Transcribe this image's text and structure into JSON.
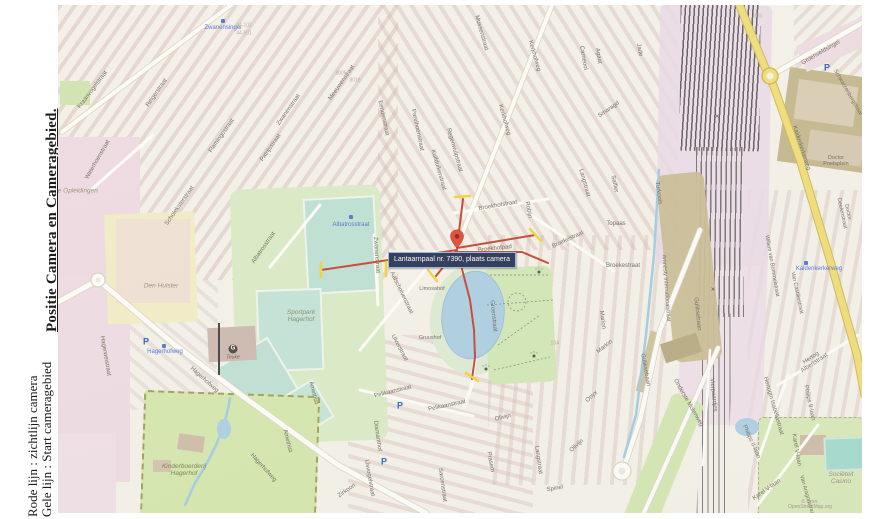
{
  "sidebar": {
    "title": "Positie Camera en Cameragebied.",
    "legend_red": "Rode lijn : zichtlijn camera",
    "legend_yellow": "Gele lijn : Start cameragebied"
  },
  "map": {
    "tooltip": "Lantaarnpaal nr. 7390, plaats camera",
    "attribution": "© Bron: OpenStreetMap.org",
    "colors": {
      "sightline_red": "#c23b28",
      "camera_area_yellow": "#f2d22e",
      "tooltip_bg": "#1f2c4e",
      "main_road_yellow": "#f0dc74",
      "water_blue": "#a9cee3",
      "park_green": "#cfe7b4",
      "sportfield_teal": "#badfd2",
      "railway_purple": "#e9d8e6",
      "transit_blue": "#4b6fd1"
    },
    "labels": [
      {
        "t": "Kraanvogelstraat",
        "x": 35,
        "y": 85,
        "r": -53,
        "c": "street"
      },
      {
        "t": "Waterhoenstraat",
        "x": 40,
        "y": 155,
        "r": -60,
        "c": "street"
      },
      {
        "t": "Reigerstraat",
        "x": 99,
        "y": 88,
        "r": -55,
        "c": "street"
      },
      {
        "t": "Flamingostraat",
        "x": 164,
        "y": 131,
        "r": -55,
        "c": "street"
      },
      {
        "t": "Scholeksterstraat",
        "x": 122,
        "y": 201,
        "r": -55,
        "c": "street"
      },
      {
        "t": "Zwanenstraat",
        "x": 231,
        "y": 105,
        "r": -55,
        "c": "street"
      },
      {
        "t": "Meeuwenstraat",
        "x": 284,
        "y": 78,
        "r": -55,
        "c": "street"
      },
      {
        "t": "Patrijsstraat",
        "x": 213,
        "y": 143,
        "r": -55,
        "c": "street"
      },
      {
        "t": "Albatrosstraat",
        "x": 206,
        "y": 243,
        "r": -55,
        "c": "street"
      },
      {
        "t": "Eendenstraat",
        "x": 325,
        "y": 113,
        "r": 78,
        "c": "street"
      },
      {
        "t": "Parelhoenstraat",
        "x": 359,
        "y": 125,
        "r": 78,
        "c": "street"
      },
      {
        "t": "Regenwulpstraat",
        "x": 396,
        "y": 145,
        "r": 74,
        "c": "street"
      },
      {
        "t": "Kuifduikerstraat",
        "x": 380,
        "y": 165,
        "r": 74,
        "c": "street"
      },
      {
        "t": "Mussenstraat",
        "x": 423,
        "y": 28,
        "r": 74,
        "c": "street"
      },
      {
        "t": "Kerkhofweg",
        "x": 476,
        "y": 51,
        "r": 74,
        "c": "street"
      },
      {
        "t": "Kerkhofweg",
        "x": 446,
        "y": 115,
        "r": 74,
        "c": "street"
      },
      {
        "t": "Carneool",
        "x": 525,
        "y": 53,
        "r": 80,
        "c": "street"
      },
      {
        "t": "Agaat",
        "x": 540,
        "y": 51,
        "r": 80,
        "c": "street"
      },
      {
        "t": "Smaragd",
        "x": 551,
        "y": 105,
        "r": -35,
        "c": "street"
      },
      {
        "t": "Jade",
        "x": 581,
        "y": 45,
        "r": 80,
        "c": "street"
      },
      {
        "t": "Saffier",
        "x": 556,
        "y": 179,
        "r": 78,
        "c": "street"
      },
      {
        "t": "Topaas",
        "x": 558,
        "y": 219,
        "r": 0,
        "c": "street"
      },
      {
        "t": "Turkoois",
        "x": 600,
        "y": 188,
        "r": 82,
        "c": "street"
      },
      {
        "t": "Robijn",
        "x": 470,
        "y": 205,
        "r": 80,
        "c": "street"
      },
      {
        "t": "Langstraat",
        "x": 526,
        "y": 178,
        "r": 74,
        "c": "street"
      },
      {
        "t": "Broekhofstraat",
        "x": 440,
        "y": 201,
        "r": -10,
        "c": "street"
      },
      {
        "t": "Broekhofpad",
        "x": 437,
        "y": 244,
        "r": -6,
        "c": "street"
      },
      {
        "t": "Broekestraat",
        "x": 510,
        "y": 235,
        "r": -25,
        "c": "street"
      },
      {
        "t": "Broekestraat",
        "x": 565,
        "y": 261,
        "r": 0,
        "c": "street"
      },
      {
        "t": "Marion",
        "x": 544,
        "y": 315,
        "r": 82,
        "c": "street"
      },
      {
        "t": "Marion",
        "x": 547,
        "y": 342,
        "r": -38,
        "c": "street"
      },
      {
        "t": "Onyx",
        "x": 534,
        "y": 392,
        "r": -42,
        "c": "street"
      },
      {
        "t": "Olivijn",
        "x": 445,
        "y": 413,
        "r": -14,
        "c": "street"
      },
      {
        "t": "Olivijn",
        "x": 519,
        "y": 441,
        "r": -42,
        "c": "street"
      },
      {
        "t": "Spinel",
        "x": 497,
        "y": 484,
        "r": -10,
        "c": "street"
      },
      {
        "t": "Prasem",
        "x": 432,
        "y": 457,
        "r": 80,
        "c": "street"
      },
      {
        "t": "Langstraat",
        "x": 480,
        "y": 455,
        "r": 82,
        "c": "street"
      },
      {
        "t": "Pelikaanstraat",
        "x": 335,
        "y": 387,
        "r": -14,
        "c": "street"
      },
      {
        "t": "Pelikaanstraat",
        "x": 389,
        "y": 401,
        "r": -12,
        "c": "street"
      },
      {
        "t": "Uiverstraat",
        "x": 341,
        "y": 343,
        "r": 62,
        "c": "street"
      },
      {
        "t": "Diamanthof",
        "x": 319,
        "y": 431,
        "r": 82,
        "c": "street"
      },
      {
        "t": "IJsvogelstraat",
        "x": 311,
        "y": 473,
        "r": 80,
        "c": "street"
      },
      {
        "t": "Sarcenstraat",
        "x": 384,
        "y": 480,
        "r": 82,
        "c": "street"
      },
      {
        "t": "Zirkoon",
        "x": 289,
        "y": 486,
        "r": -35,
        "c": "street"
      },
      {
        "t": "Amethist",
        "x": 255,
        "y": 388,
        "r": 76,
        "c": "street"
      },
      {
        "t": "Amethist",
        "x": 229,
        "y": 436,
        "r": 76,
        "c": "street"
      },
      {
        "t": "Hagerhofweg",
        "x": 146,
        "y": 375,
        "r": 42,
        "c": "street"
      },
      {
        "t": "Hagerhofweg",
        "x": 205,
        "y": 463,
        "r": 48,
        "c": "street"
      },
      {
        "t": "Hagerweistraat",
        "x": 47,
        "y": 351,
        "r": 80,
        "c": "street"
      },
      {
        "t": "Groenstraat",
        "x": 435,
        "y": 311,
        "r": 84,
        "c": "street"
      },
      {
        "t": "Aalscholverstraat",
        "x": 343,
        "y": 288,
        "r": 64,
        "c": "street"
      },
      {
        "t": "Zwanenstraat",
        "x": 318,
        "y": 250,
        "r": 86,
        "c": "street"
      },
      {
        "t": "Limosahof",
        "x": 374,
        "y": 285,
        "r": 0,
        "c": "street",
        "s": 5.5
      },
      {
        "t": "Gruushof",
        "x": 372,
        "y": 334,
        "r": 0,
        "c": "street",
        "s": 5.5
      },
      {
        "t": "Guliksebaan",
        "x": 639,
        "y": 309,
        "r": 84,
        "c": "street"
      },
      {
        "t": "Guliksebaan",
        "x": 587,
        "y": 365,
        "r": 80,
        "c": "street"
      },
      {
        "t": "Amnesty Internationalstraat",
        "x": 607,
        "y": 283,
        "r": 86,
        "c": "street",
        "s": 5.5
      },
      {
        "t": "Vierpaardjes",
        "x": 655,
        "y": 390,
        "r": 84,
        "c": "street"
      },
      {
        "t": "Onderste Molenweg",
        "x": 630,
        "y": 398,
        "r": 60,
        "c": "street"
      },
      {
        "t": "Kaldenkerkerweg",
        "x": 743,
        "y": 143,
        "r": 72,
        "c": "street"
      },
      {
        "t": "Groenveldsingel",
        "x": 763,
        "y": 48,
        "r": -30,
        "c": "street"
      },
      {
        "t": "Schwarzenbergstraat",
        "x": 789,
        "y": 88,
        "r": 60,
        "c": "street",
        "s": 5.5
      },
      {
        "t": "Doctor Poelsplein",
        "x": 778,
        "y": 157,
        "r": 0,
        "c": "street",
        "s": 5.5
      },
      {
        "t": "Doctor Deelenstraat",
        "x": 786,
        "y": 208,
        "r": 78,
        "c": "street",
        "s": 5.5
      },
      {
        "t": "Willem van Bommelstraat",
        "x": 713,
        "y": 261,
        "r": 80,
        "c": "street",
        "s": 5.5
      },
      {
        "t": "Van Castiliestraat",
        "x": 738,
        "y": 288,
        "r": 78,
        "c": "street",
        "s": 5.5
      },
      {
        "t": "Hertog Albertstraat",
        "x": 755,
        "y": 356,
        "r": -33,
        "c": "street"
      },
      {
        "t": "Hertogin Isabellastraat",
        "x": 715,
        "y": 401,
        "r": 74,
        "c": "street"
      },
      {
        "t": "Philips II-laan",
        "x": 693,
        "y": 437,
        "r": 66,
        "c": "street"
      },
      {
        "t": "Philips II-laan",
        "x": 751,
        "y": 398,
        "r": 78,
        "c": "street"
      },
      {
        "t": "Karel V-laan",
        "x": 738,
        "y": 445,
        "r": 80,
        "c": "street"
      },
      {
        "t": "Karel V-laan",
        "x": 709,
        "y": 485,
        "r": -35,
        "c": "street"
      },
      {
        "t": "Van Aragonstraat",
        "x": 748,
        "y": 491,
        "r": 74,
        "c": "street",
        "s": 5.5
      },
      {
        "t": "×",
        "x": 659,
        "y": 112,
        "r": 0,
        "c": "num",
        "s": 7,
        "col": "#444"
      },
      {
        "t": "×",
        "x": 655,
        "y": 285,
        "r": 0,
        "c": "num",
        "s": 7,
        "col": "#444"
      },
      {
        "t": "Gilde Opleidingen",
        "x": 14,
        "y": 187,
        "r": 0,
        "c": "area"
      },
      {
        "t": "Den Hulster",
        "x": 103,
        "y": 282,
        "r": 0,
        "c": "area"
      },
      {
        "t": "Sportpark\nHagerhof",
        "x": 243,
        "y": 312,
        "r": 0,
        "c": "area",
        "col": "#7f8a68"
      },
      {
        "t": "Kinderboerderij\nHagerhof",
        "x": 126,
        "y": 466,
        "r": 0,
        "c": "area",
        "col": "#6f7a4f"
      },
      {
        "t": "Sociëteit\nCasino",
        "x": 783,
        "y": 474,
        "r": 0,
        "c": "area"
      },
      {
        "t": "Teuke",
        "x": 175,
        "y": 353,
        "r": 0,
        "c": "area",
        "s": 5,
        "col": "#5d574f"
      },
      {
        "t": "Zwanensingel",
        "x": 165,
        "y": 23,
        "r": 0,
        "c": "transit"
      },
      {
        "t": "Albatrosstraat",
        "x": 293,
        "y": 220,
        "r": 0,
        "c": "transit"
      },
      {
        "t": "Hagerhofweg",
        "x": 107,
        "y": 347,
        "r": 0,
        "c": "transit"
      },
      {
        "t": "Kaldenkerkerweg",
        "x": 761,
        "y": 264,
        "r": 0,
        "c": "transit"
      },
      {
        "t": "44-102",
        "x": 186,
        "y": 21,
        "r": 0,
        "c": "num"
      },
      {
        "t": "44-501",
        "x": 186,
        "y": 29,
        "r": 0,
        "c": "num"
      },
      {
        "t": "8005",
        "x": 283,
        "y": 69,
        "r": 0,
        "c": "num"
      },
      {
        "t": "8018",
        "x": 297,
        "y": 76,
        "r": 0,
        "c": "num"
      },
      {
        "t": "10A",
        "x": 497,
        "y": 339,
        "r": 0,
        "c": "num"
      },
      {
        "t": "103",
        "x": 700,
        "y": 12,
        "r": 0,
        "c": "num"
      },
      {
        "t": "P",
        "x": 88,
        "y": 337,
        "r": 0,
        "c": "p"
      },
      {
        "t": "P",
        "x": 342,
        "y": 401,
        "r": 0,
        "c": "p"
      },
      {
        "t": "P",
        "x": 326,
        "y": 457,
        "r": 0,
        "c": "p"
      },
      {
        "t": "P",
        "x": 769,
        "y": 63,
        "r": 0,
        "c": "p"
      },
      {
        "t": "",
        "x": 165,
        "y": 16,
        "r": 0,
        "c": "bus"
      },
      {
        "t": "",
        "x": 293,
        "y": 212,
        "r": 0,
        "c": "bus"
      },
      {
        "t": "",
        "x": 106,
        "y": 341,
        "r": 0,
        "c": "bus"
      },
      {
        "t": "",
        "x": 748,
        "y": 258,
        "r": 0,
        "c": "bus"
      },
      {
        "t": "",
        "x": 428,
        "y": 364,
        "r": 0,
        "c": "paw"
      },
      {
        "t": "",
        "x": 476,
        "y": 351,
        "r": 0,
        "c": "paw"
      },
      {
        "t": "",
        "x": 481,
        "y": 267,
        "r": 0,
        "c": "paw"
      },
      {
        "t": "G",
        "x": 175,
        "y": 344,
        "r": 0,
        "c": "g"
      },
      {
        "t": "© Bron: OpenStreetMap.org",
        "x": 752,
        "y": 500,
        "r": 0,
        "c": "attr"
      }
    ]
  }
}
